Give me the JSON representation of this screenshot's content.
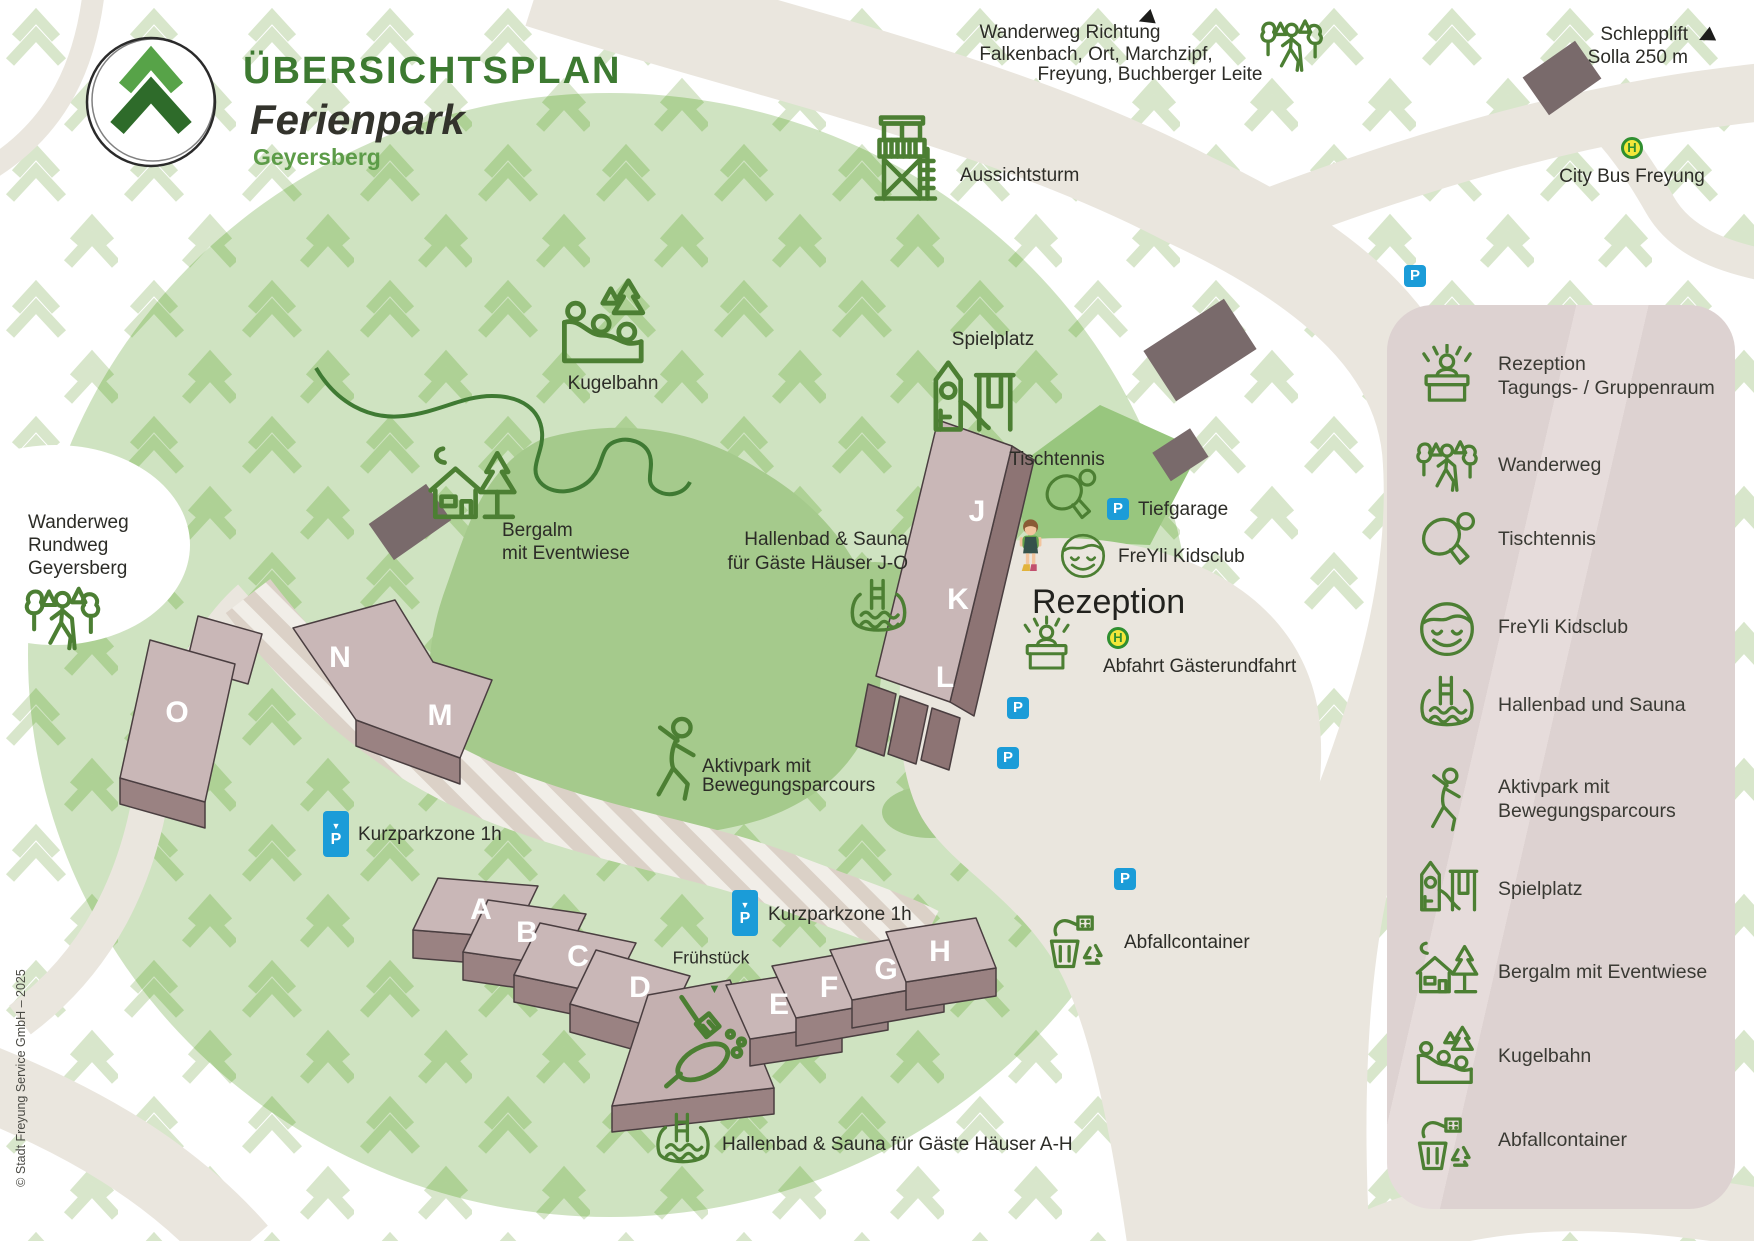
{
  "brand": {
    "title": "ÜBERSICHTSPLAN",
    "subtitle": "Ferienpark",
    "region": "Geyersberg"
  },
  "map": {
    "labels": {
      "wanderweg_richtung_1": "Wanderweg Richtung",
      "wanderweg_richtung_2": "Falkenbach, Ort, Marchzipf,",
      "wanderweg_richtung_3": "Freyung, Buchberger Leite",
      "schlepplift_1": "Schlepplift",
      "schlepplift_2": "Solla 250 m",
      "city_bus": "City Bus Freyung",
      "aussichtsturm": "Aussichtsturm",
      "spielplatz": "Spielplatz",
      "kugelbahn": "Kugelbahn",
      "bergalm_1": "Bergalm",
      "bergalm_2": "mit Eventwiese",
      "tischtennis": "Tischtennis",
      "tiefgarage": "Tiefgarage",
      "freyli_kidsclub": "FreYli Kidsclub",
      "rezeption": "Rezeption",
      "abfahrt": "Abfahrt Gästerundfahrt",
      "hallenbad_jo_1": "Hallenbad & Sauna",
      "hallenbad_jo_2": "für Gäste Häuser J-O",
      "aktivpark_1": "Aktivpark mit",
      "aktivpark_2": "Bewegungsparcours",
      "kurzparkzone_left": "Kurzparkzone 1h",
      "kurzparkzone_mid": "Kurzparkzone 1h",
      "fruehstueck": "Frühstück",
      "hallenbad_ah": "Hallenbad & Sauna für Gäste Häuser A-H",
      "abfallcontainer": "Abfallcontainer",
      "wanderweg_rundweg_1": "Wanderweg",
      "wanderweg_rundweg_2": "Rundweg",
      "wanderweg_rundweg_3": "Geyersberg"
    },
    "arrows": {
      "left": "◀",
      "down": "▼"
    },
    "signs": {
      "parking": "P",
      "bus": "H"
    },
    "buildings": [
      "A",
      "B",
      "C",
      "D",
      "E",
      "F",
      "G",
      "H",
      "J",
      "K",
      "L",
      "M",
      "N",
      "O"
    ],
    "colors": {
      "park_green": "#cfe3c1",
      "meadow_green": "#a5ca8c",
      "road_grey": "#eae6de",
      "building_pink": "#c9b7b7",
      "parking_blue": "#1b9cd8",
      "icon_green": "#4c7f33"
    }
  },
  "legend": {
    "items": [
      {
        "icon": "reception-icon",
        "label": "Rezeption",
        "label2": "Tagungs- / Gruppenraum"
      },
      {
        "icon": "wanderweg-icon",
        "label": "Wanderweg"
      },
      {
        "icon": "tischtennis-icon",
        "label": "Tischtennis"
      },
      {
        "icon": "kidsclub-icon",
        "label": "FreYli Kidsclub"
      },
      {
        "icon": "hallenbad-icon",
        "label": "Hallenbad und Sauna"
      },
      {
        "icon": "aktivpark-icon",
        "label": "Aktivpark mit",
        "label2": "Bewegungsparcours"
      },
      {
        "icon": "spielplatz-icon",
        "label": "Spielplatz"
      },
      {
        "icon": "bergalm-icon",
        "label": "Bergalm mit Eventwiese"
      },
      {
        "icon": "kugelbahn-icon",
        "label": "Kugelbahn"
      },
      {
        "icon": "abfallcontainer-icon",
        "label": "Abfallcontainer"
      }
    ]
  },
  "footer": {
    "copyright": "© Stadt Freyung Service GmbH – 2025"
  }
}
